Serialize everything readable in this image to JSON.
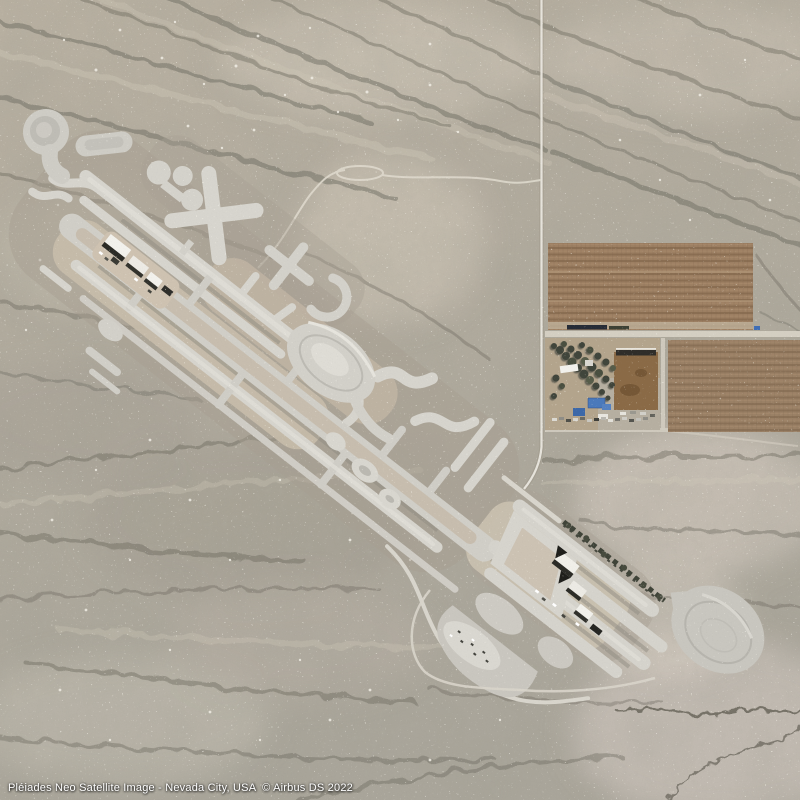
{
  "image": {
    "provider": "Pléiades Neo",
    "type_label": "Satellite Image",
    "location": "Nevada City, USA",
    "credit": "© Airbus DS 2022",
    "caption": "Pléiades Neo Satellite Image - Nevada City, USA  © Airbus DS 2022"
  },
  "palette": {
    "caption_text": "#ffffff",
    "desert_base": "#b2ab9e",
    "desert_light": "#d6cfc1",
    "desert_dark": "#66635a",
    "track_light": "#d6d4cd",
    "track_mid": "#c7c5be",
    "track_tan": "#c8bcab",
    "field_brown": "#9c7f62",
    "field_row": "#8a6e52",
    "tree_green": "#40443a",
    "roof_blue": "#4a79bb",
    "corral_brown": "#8a6a46",
    "building_white": "#f2f1ec",
    "shadow_black": "#2b2b26",
    "road_white": "#eae7df"
  }
}
